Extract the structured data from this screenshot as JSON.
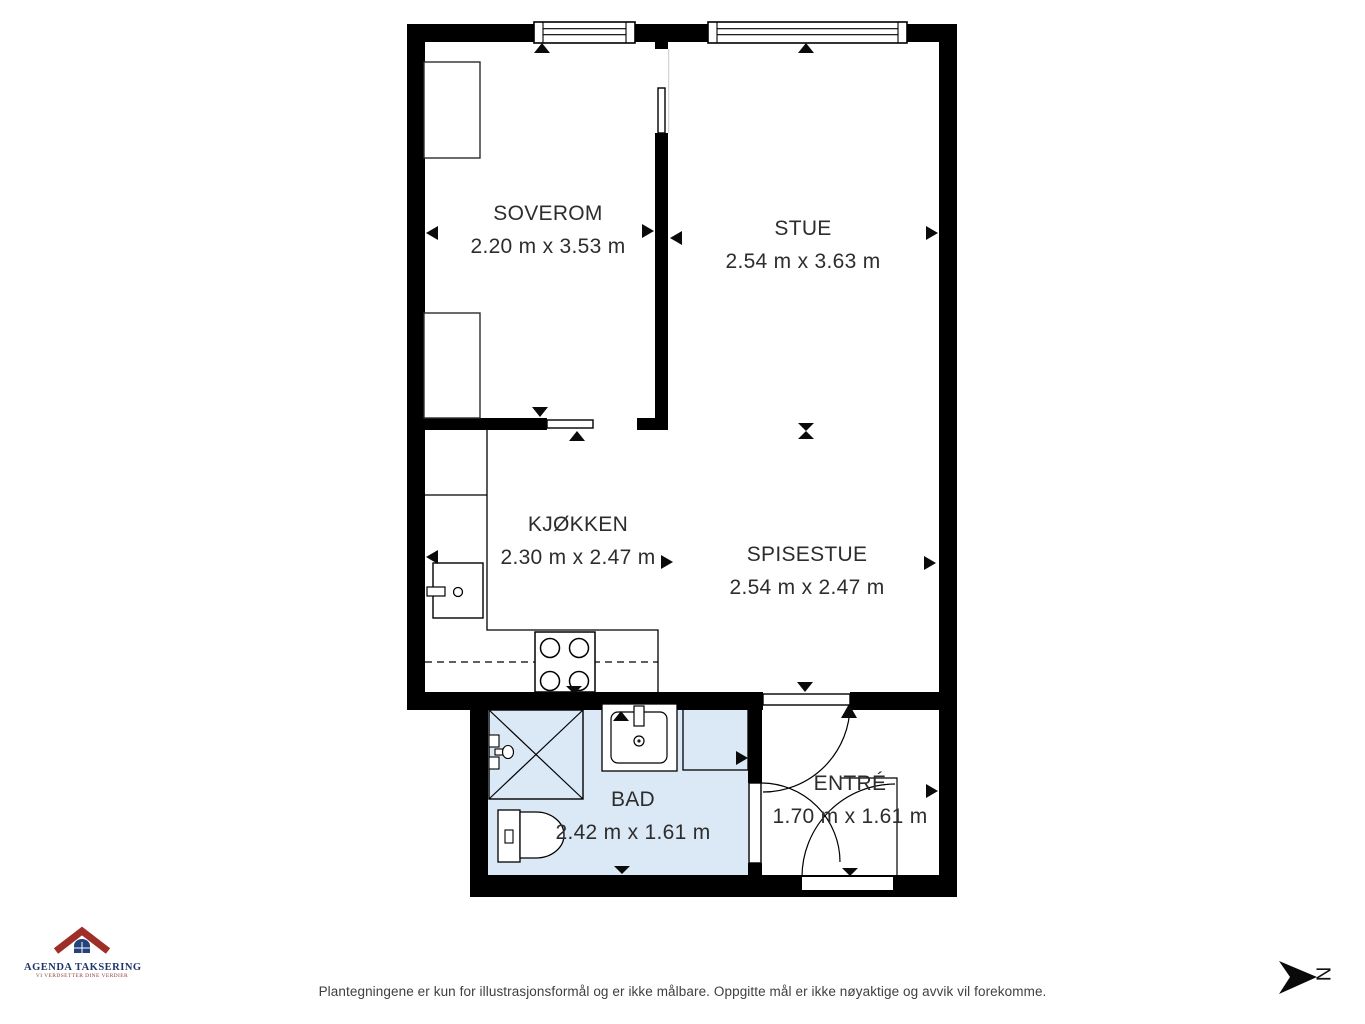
{
  "floorplan": {
    "rooms": [
      {
        "id": "soverom",
        "name": "SOVEROM",
        "dims": "2.20 m x 3.53 m"
      },
      {
        "id": "stue",
        "name": "STUE",
        "dims": "2.54 m x 3.63 m"
      },
      {
        "id": "kjokken",
        "name": "KJØKKEN",
        "dims": "2.30 m x 2.47 m"
      },
      {
        "id": "spisestue",
        "name": "SPISESTUE",
        "dims": "2.54 m x 2.47 m"
      },
      {
        "id": "bad",
        "name": "BAD",
        "dims": "2.42 m x 1.61 m"
      },
      {
        "id": "entre",
        "name": "ENTRÉ",
        "dims": "1.70 m x 1.61 m"
      }
    ]
  },
  "branding": {
    "logo_title": "AGENDA TAKSERING",
    "logo_tagline": "VI VERDSETTER DINE VERDIER"
  },
  "footer": {
    "disclaimer": "Plantegningene er kun for illustrasjonsformål og er ikke målbare. Oppgitte mål er ikke nøyaktige og avvik vil forekomme."
  },
  "compass": {
    "north_label": "N"
  },
  "colors": {
    "wall": "#000000",
    "bathroom_fill": "#dbe9f6",
    "line": "#1a1a1a",
    "logo_red": "#9e2f28",
    "logo_blue": "#24427c"
  }
}
